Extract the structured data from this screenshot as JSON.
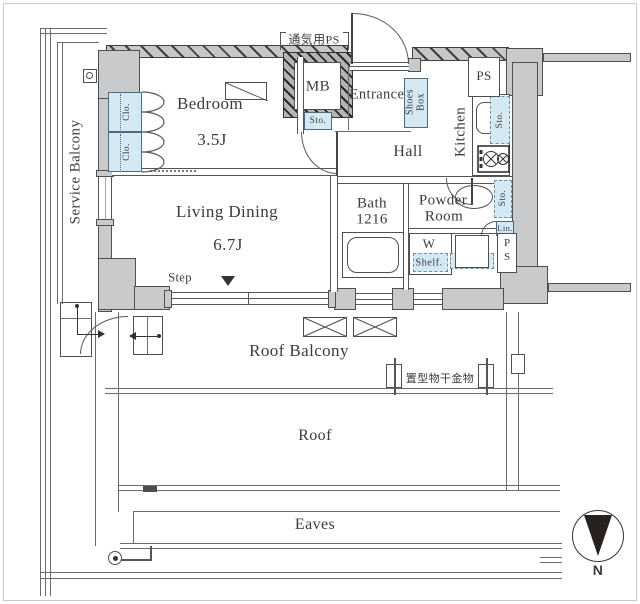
{
  "labels": {
    "service_balcony": "Service Balcony",
    "bedroom": "Bedroom",
    "bedroom_size": "3.5J",
    "clo": "Clo.",
    "vent_ps": "通気用PS",
    "mb": "MB",
    "sto": "Sto.",
    "entrance": "Entrance",
    "shoes_box": "Shoes Box",
    "ps": "PS",
    "kitchen": "Kitchen",
    "hall": "Hall",
    "bath": "Bath",
    "bath_size": "1216",
    "powder_room_line1": "Powder",
    "powder_room_line2": "Room",
    "lin": "Lin.",
    "washer": "W",
    "shelf": "Shelf.",
    "living_dining": "Living Dining",
    "living_size": "6.7J",
    "step": "Step",
    "roof_balcony": "Roof Balcony",
    "laundry_fixture": "置型物干金物",
    "roof": "Roof",
    "eaves": "Eaves",
    "north": "N"
  },
  "colors": {
    "wall_fill": "#c9cacb",
    "storage_fill": "#d5e9f5",
    "outline": "#4d4d4d",
    "text": "#3c3c3c"
  }
}
